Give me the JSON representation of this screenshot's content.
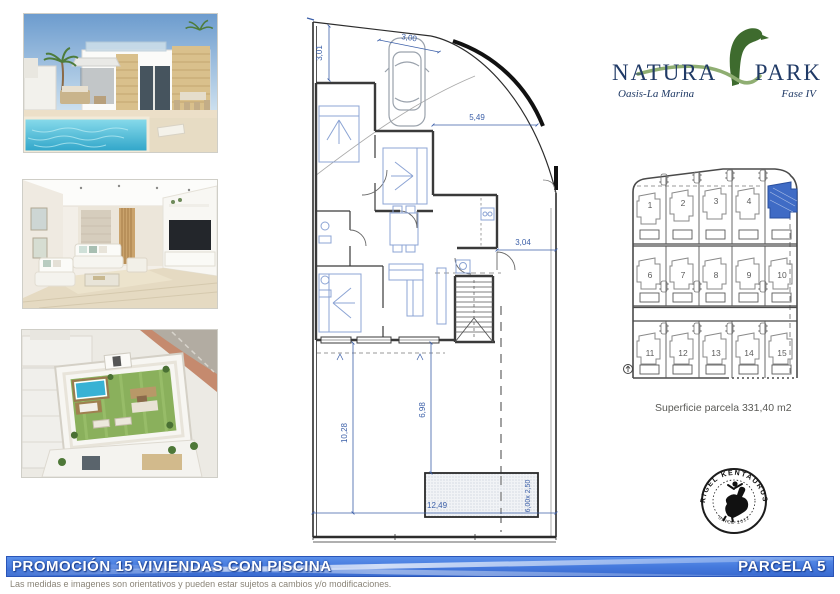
{
  "logo": {
    "name_left": "NATURA",
    "name_right": "PARK",
    "tagline": "Oasis-La Marina",
    "phase": "Fase IV"
  },
  "plan": {
    "dims": {
      "top_width": "3,00",
      "left_height": "3,01",
      "diag_width": "5,49",
      "right_offset": "3,04",
      "yard_height": "10,28",
      "pool_offset": "6,98",
      "parcel_width": "12,49",
      "pool_size": "6,00x 2,50"
    }
  },
  "sitemap": {
    "surface_label": "Superficie parcela 331,40 m2",
    "plots": [
      {
        "label": "1"
      },
      {
        "label": "2"
      },
      {
        "label": "3"
      },
      {
        "label": "4"
      },
      {
        "label": "",
        "highlighted": true
      },
      {
        "label": "6"
      },
      {
        "label": "7"
      },
      {
        "label": "8"
      },
      {
        "label": "9"
      },
      {
        "label": "10"
      },
      {
        "label": "11"
      },
      {
        "label": "12"
      },
      {
        "label": "13"
      },
      {
        "label": "14"
      },
      {
        "label": "15"
      }
    ]
  },
  "stamp": {
    "arc_top": "RIGEL KENTAURUS",
    "arc_bottom": "SINCE 2012"
  },
  "banner": {
    "title": "PROMOCIÓN 15 VIVIENDAS CON PISCINA",
    "parcel": "PARCELA 5"
  },
  "footer": {
    "disclaimer": "Las medidas e imagenes son orientativos y pueden estar sujetos a cambios y/o modificaciones."
  },
  "colors": {
    "banner_blue": "#4478dc",
    "dimension_blue": "#3b5fa8",
    "highlight_blue": "#3f6bc5",
    "logo_navy": "#203a66",
    "logo_green": "#49762f"
  }
}
